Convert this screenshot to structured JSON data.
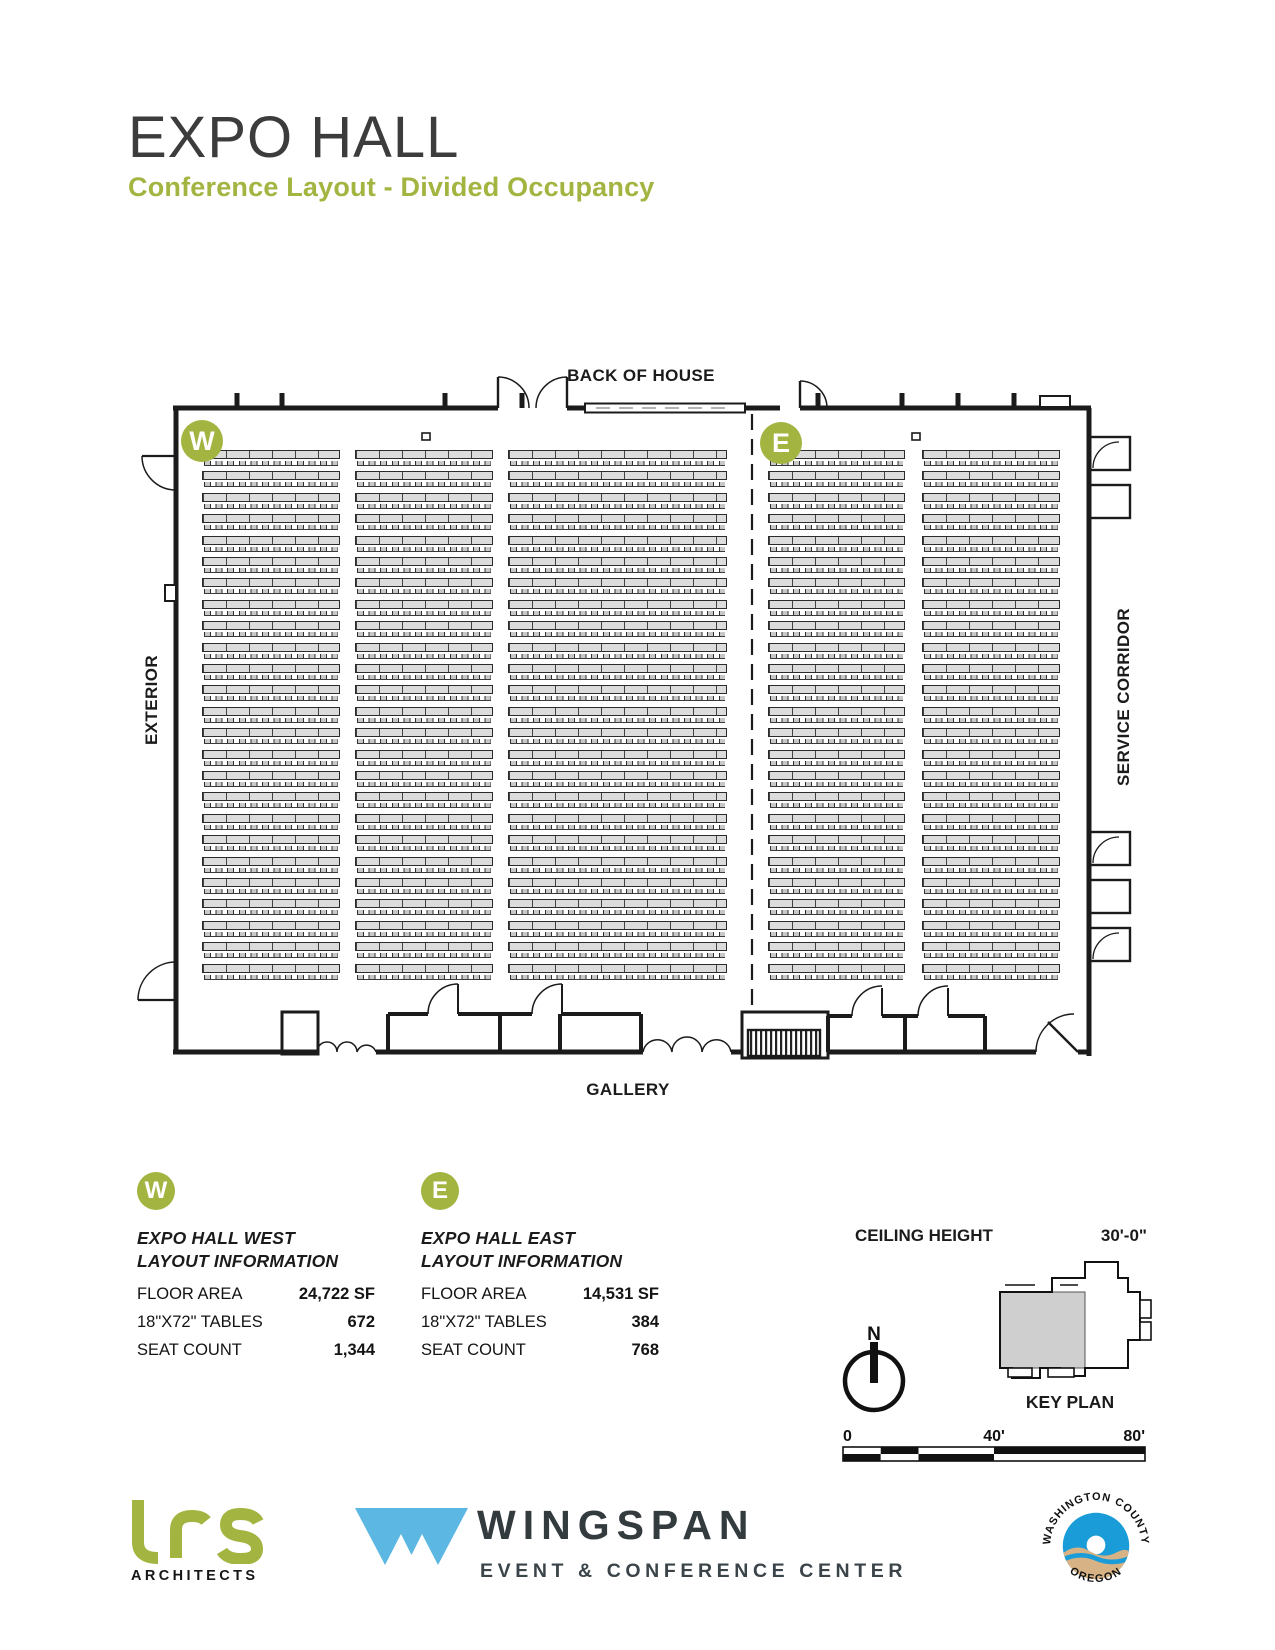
{
  "header": {
    "title": "EXPO HALL",
    "subtitle": "Conference Layout - Divided Occupancy"
  },
  "plan": {
    "labels": {
      "top": "BACK OF HOUSE",
      "bottom": "GALLERY",
      "left": "EXTERIOR",
      "right": "SERVICE CORRIDOR"
    },
    "markers": {
      "west": "W",
      "east": "E"
    },
    "tables": {
      "row_top": 450,
      "row_count": 25,
      "row_pitch": 21.4,
      "table_height": 9,
      "chair_height": 5,
      "groups": [
        {
          "x": 202,
          "w": 138
        },
        {
          "x": 355,
          "w": 138
        },
        {
          "x": 508,
          "w": 219
        },
        {
          "x": 768,
          "w": 137
        },
        {
          "x": 922,
          "w": 138
        }
      ]
    }
  },
  "info_panels": [
    {
      "marker": "W",
      "name": "EXPO HALL WEST",
      "subname": "LAYOUT INFORMATION",
      "rows": [
        {
          "label": "FLOOR AREA",
          "value": "24,722 SF"
        },
        {
          "label": "18\"X72\" TABLES",
          "value": "672"
        },
        {
          "label": "SEAT COUNT",
          "value": "1,344"
        }
      ]
    },
    {
      "marker": "E",
      "name": "EXPO HALL EAST",
      "subname": "LAYOUT INFORMATION",
      "rows": [
        {
          "label": "FLOOR AREA",
          "value": "14,531 SF"
        },
        {
          "label": "18\"X72\" TABLES",
          "value": "384"
        },
        {
          "label": "SEAT COUNT",
          "value": "768"
        }
      ]
    }
  ],
  "details": {
    "ceiling_label": "CEILING HEIGHT",
    "ceiling_value": "30'-0\"",
    "north_label": "N",
    "keyplan_label": "KEY PLAN",
    "scale_ticks": [
      "0",
      "40'",
      "80'"
    ]
  },
  "footer": {
    "lrs_sub": "ARCHITECTS",
    "wingspan_name": "WINGSPAN",
    "wingspan_tagline": "EVENT & CONFERENCE CENTER",
    "seal_top": "WASHINGTON COUNTY",
    "seal_bottom": "OREGON"
  },
  "colors": {
    "accent_green": "#a4b441",
    "wingspan_blue": "#5db7e3",
    "wingspan_dark": "#333b3f",
    "seal_blue": "#1a9cd8",
    "seal_tan": "#d6b285"
  }
}
